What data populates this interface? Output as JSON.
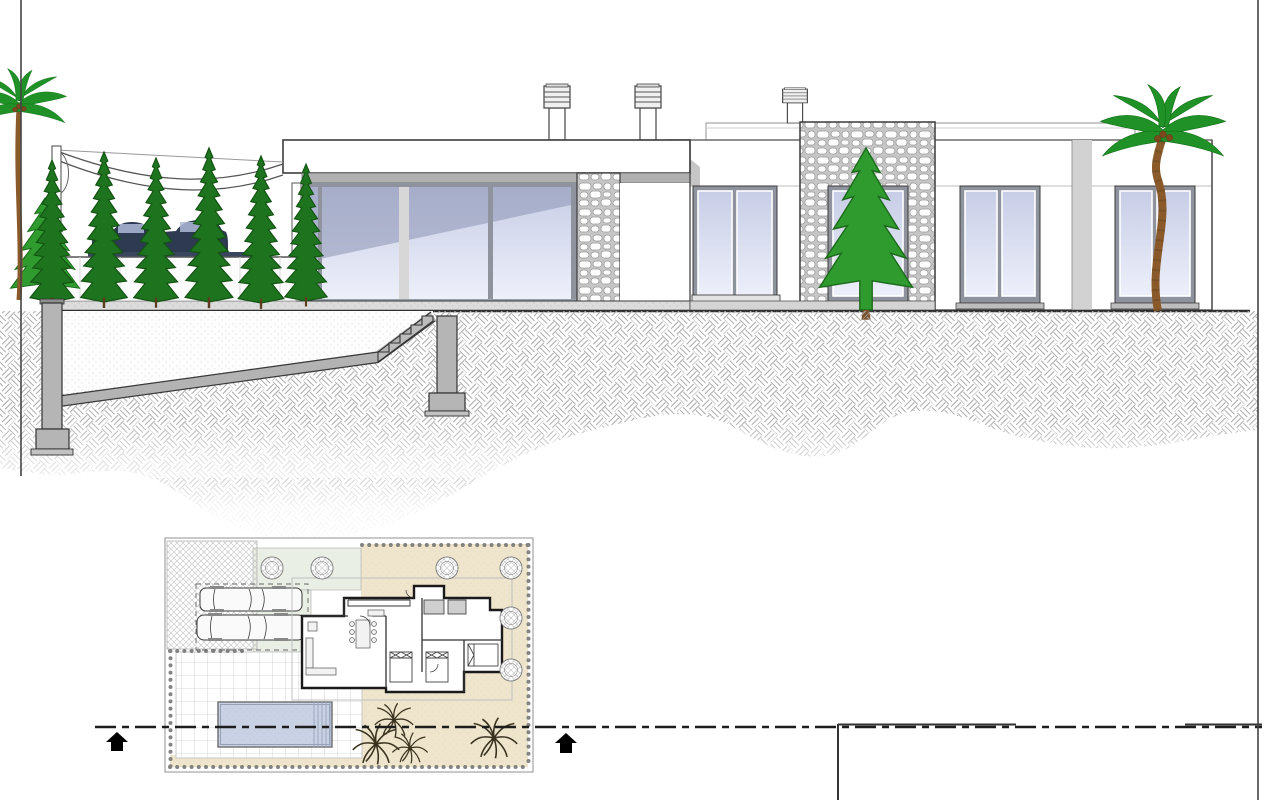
{
  "sheet": {
    "description_label": "villa-elevation-section-and-site-plan-drawing",
    "background": "#ffffff",
    "visible_text": []
  },
  "colors": {
    "ink": "#1d1d1d",
    "line": "#3a3a3a",
    "soffit": "#b0b0b0",
    "concrete": "#b5b5b5",
    "shadow_grey": "#c6c6c6",
    "glass_hi": "#edf0fa",
    "glass_lo": "#c7cde6",
    "glass_reflect": "#8d94b2",
    "frame": "#8f939e",
    "stone_bg": "#c6c6c6",
    "stone_face": "#fdfdfd",
    "earth": "#adadad",
    "terrace": "#dcdcdc",
    "cypress": "#1e741e",
    "cypress_edge": "#135313",
    "conifer": "#2f9b2f",
    "conifer_edge": "#1c6b1c",
    "palm_leaf": "#1f9126",
    "palm_trunk": "#8a5a2b",
    "car": "#2e3a52",
    "plan_beige": "#efe5cc",
    "plan_green": "#e9efe4",
    "pool": "#c9d2e4",
    "tile_line": "#cccccc",
    "bead": "#6f6f6f"
  },
  "icons": {
    "cypress_tree": "tall-serrated-cone",
    "conifer_tree": "layered-jagged-triangle",
    "palm_tree": "curved-blade-crown-with-coconuts",
    "chimney": "louvered-cap-on-shaft",
    "section_arrow": "solid-black-up-arrow",
    "plan_tree": "hatched-circle",
    "plan_palm": "radiating-line-burst"
  }
}
